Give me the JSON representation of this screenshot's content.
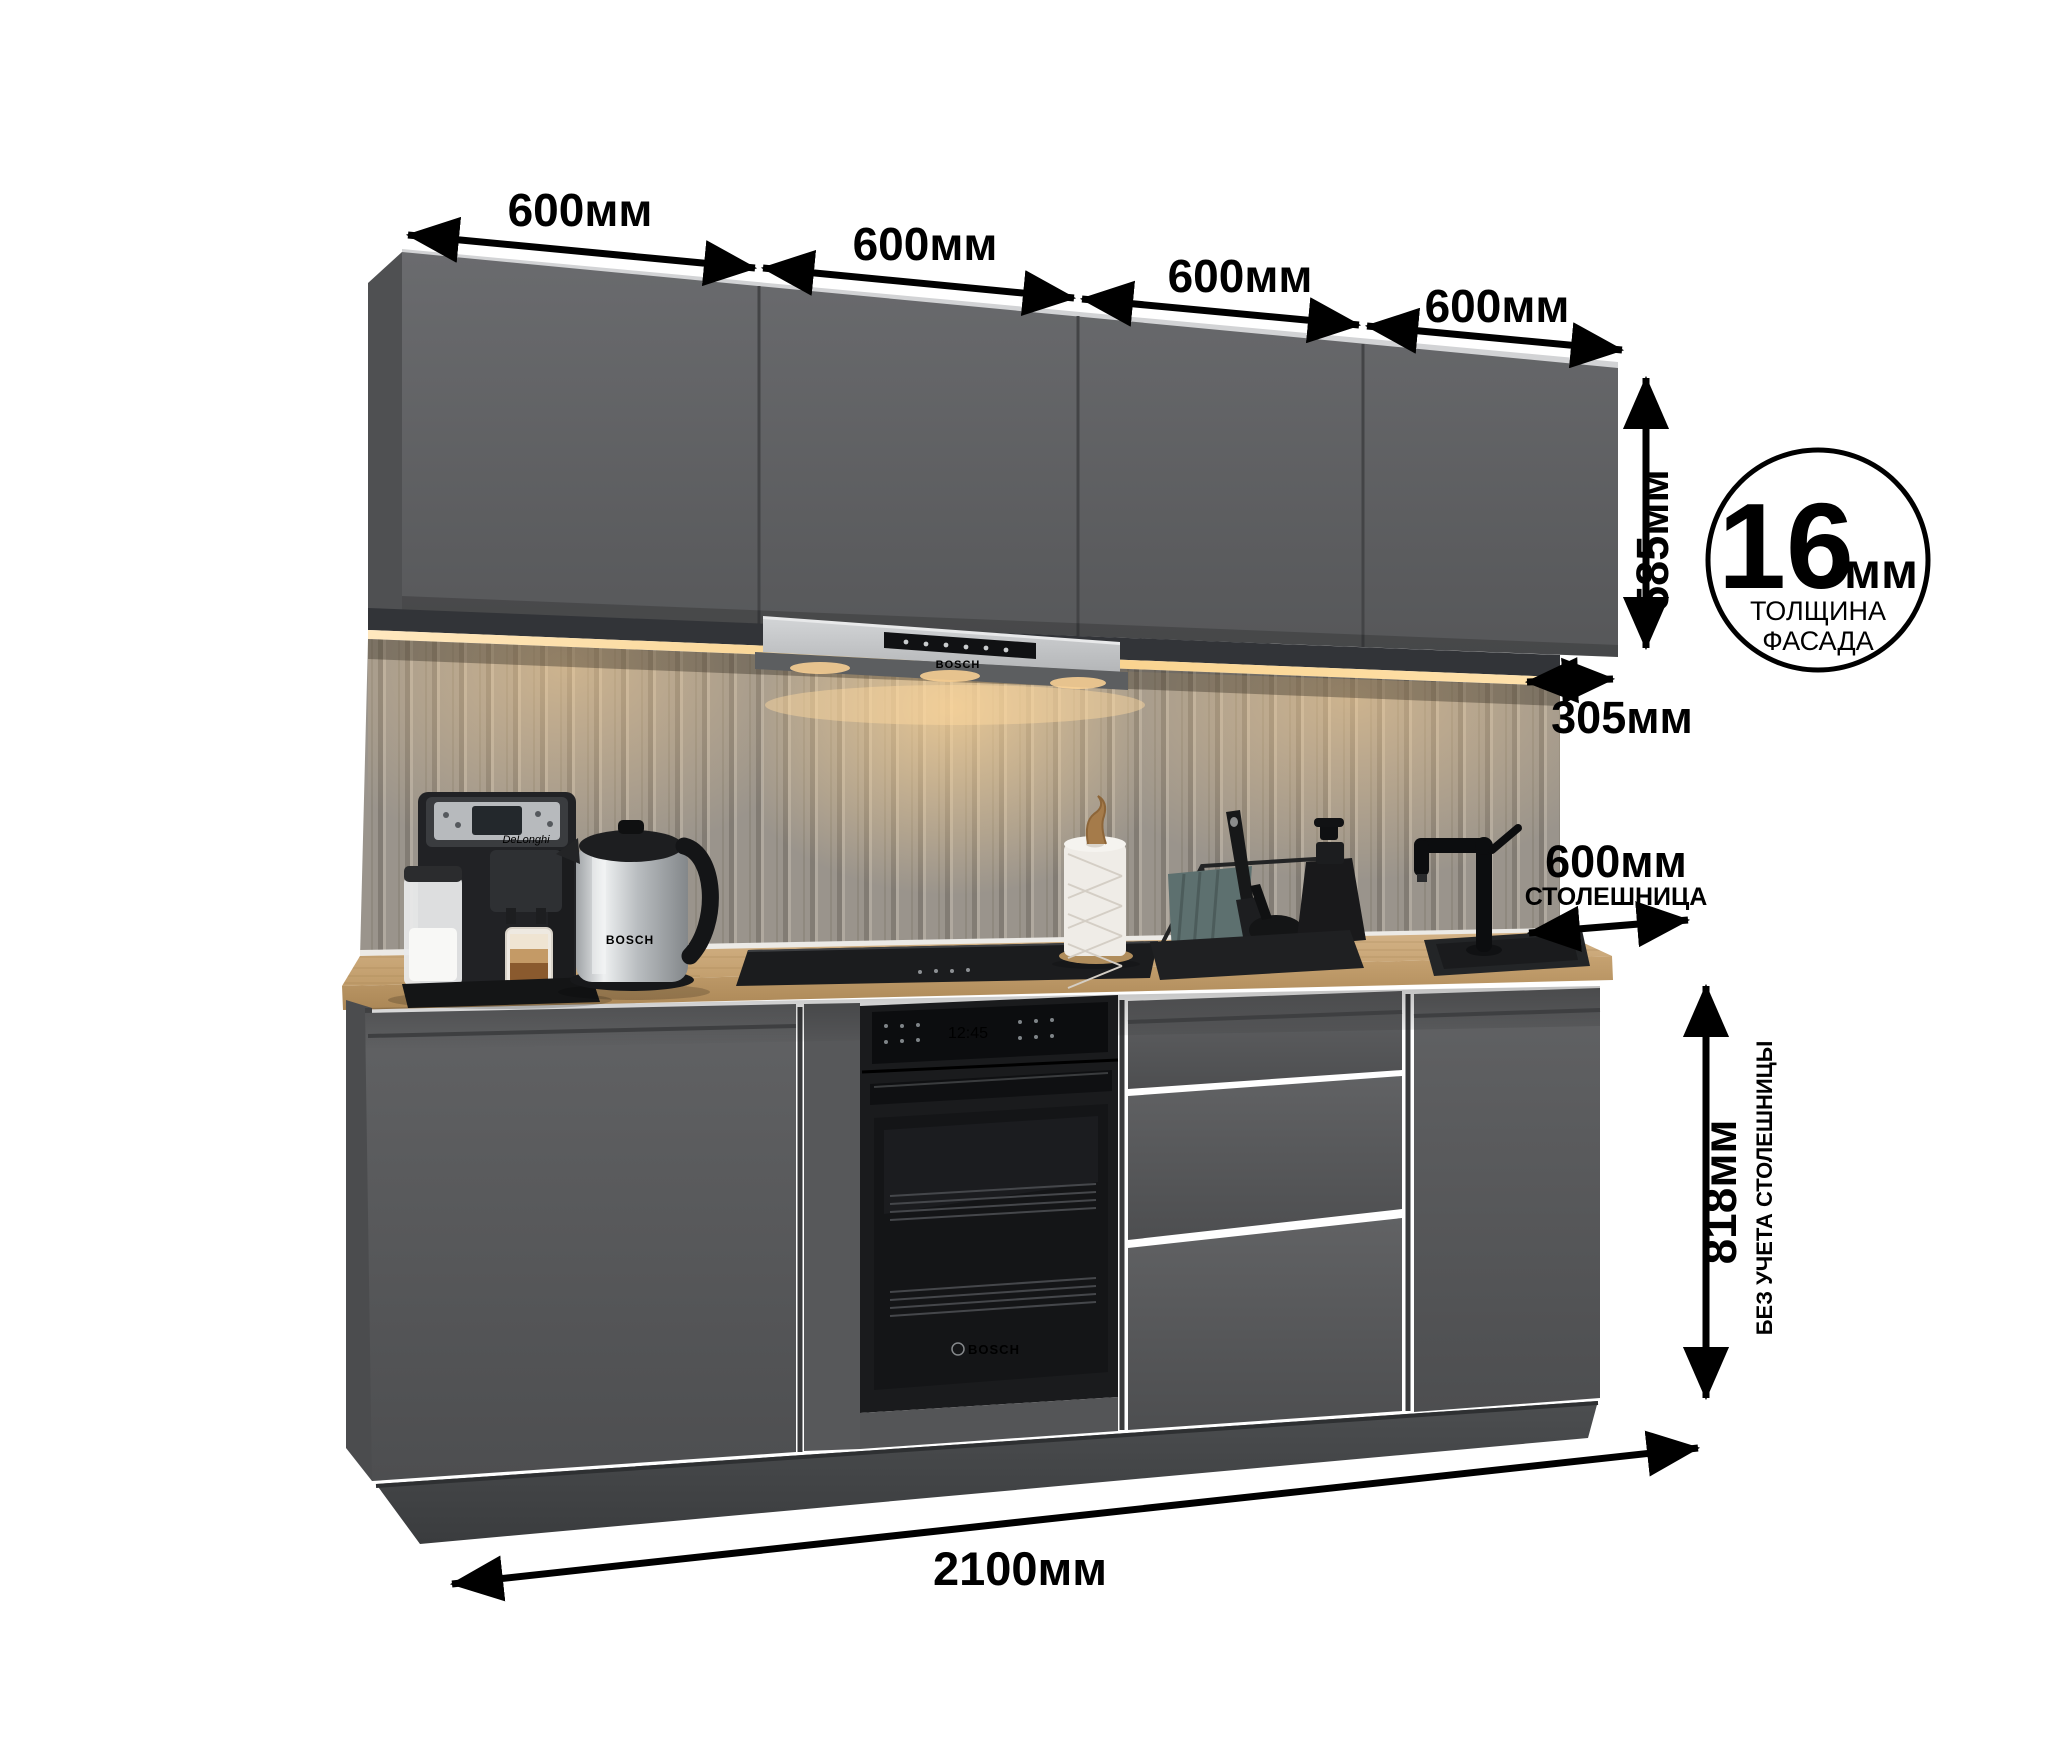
{
  "dimensions": {
    "top_widths": [
      "600мм",
      "600мм",
      "600мм",
      "600мм"
    ],
    "upper_height": "585мм",
    "upper_depth": "305мм",
    "facade_thickness": {
      "value": "16",
      "unit": "мм",
      "caption_line1": "ТОЛЩИНА",
      "caption_line2": "ФАСАДА"
    },
    "countertop": {
      "value": "600мм",
      "caption": "СТОЛЕШНИЦА"
    },
    "base_height": {
      "value": "818мм",
      "caption": "БЕЗ УЧЕТА СТОЛЕШНИЦЫ"
    },
    "total_width": "2100мм"
  },
  "appliances": {
    "hood_brand": "BOSCH",
    "oven_brand": "BOSCH",
    "oven_clock": "12:45",
    "kettle_brand": "BOSCH",
    "coffee_brand": "DeLonghi"
  },
  "colors": {
    "facade_gray": "#5e5f61",
    "countertop_wood": "#c8a877",
    "warm_light": "#ffd9a0",
    "dimension_black": "#000000"
  }
}
